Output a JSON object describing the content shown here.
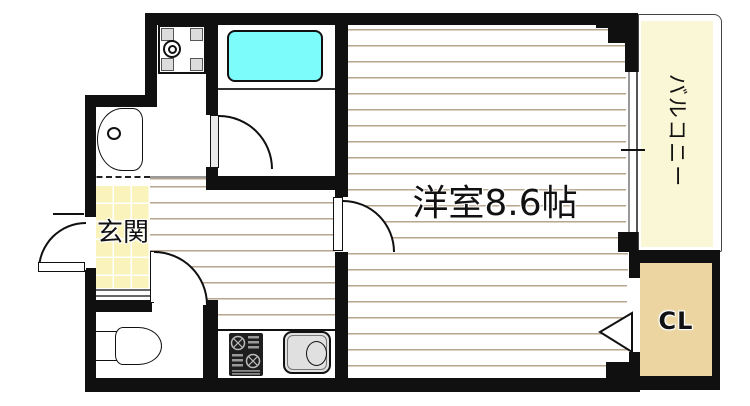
{
  "floorplan": {
    "labels": {
      "main_room": "洋室8.6帖",
      "balcony": "バルコニー",
      "closet": "CL",
      "entrance": "玄関"
    },
    "colors": {
      "wall": "#101010",
      "floor_line": "#b7a68c",
      "entrance_fill": "#faf3bb",
      "balcony_fill": "#faf7d6",
      "closet_fill": "#ecd5a1",
      "bathtub_fill": "#7dfcfc",
      "fixture_gray": "#e0e0e0"
    },
    "fixtures": [
      "washing-machine-pan",
      "washbasin",
      "bathtub",
      "toilet",
      "gas-stove",
      "kitchen-sink"
    ]
  }
}
